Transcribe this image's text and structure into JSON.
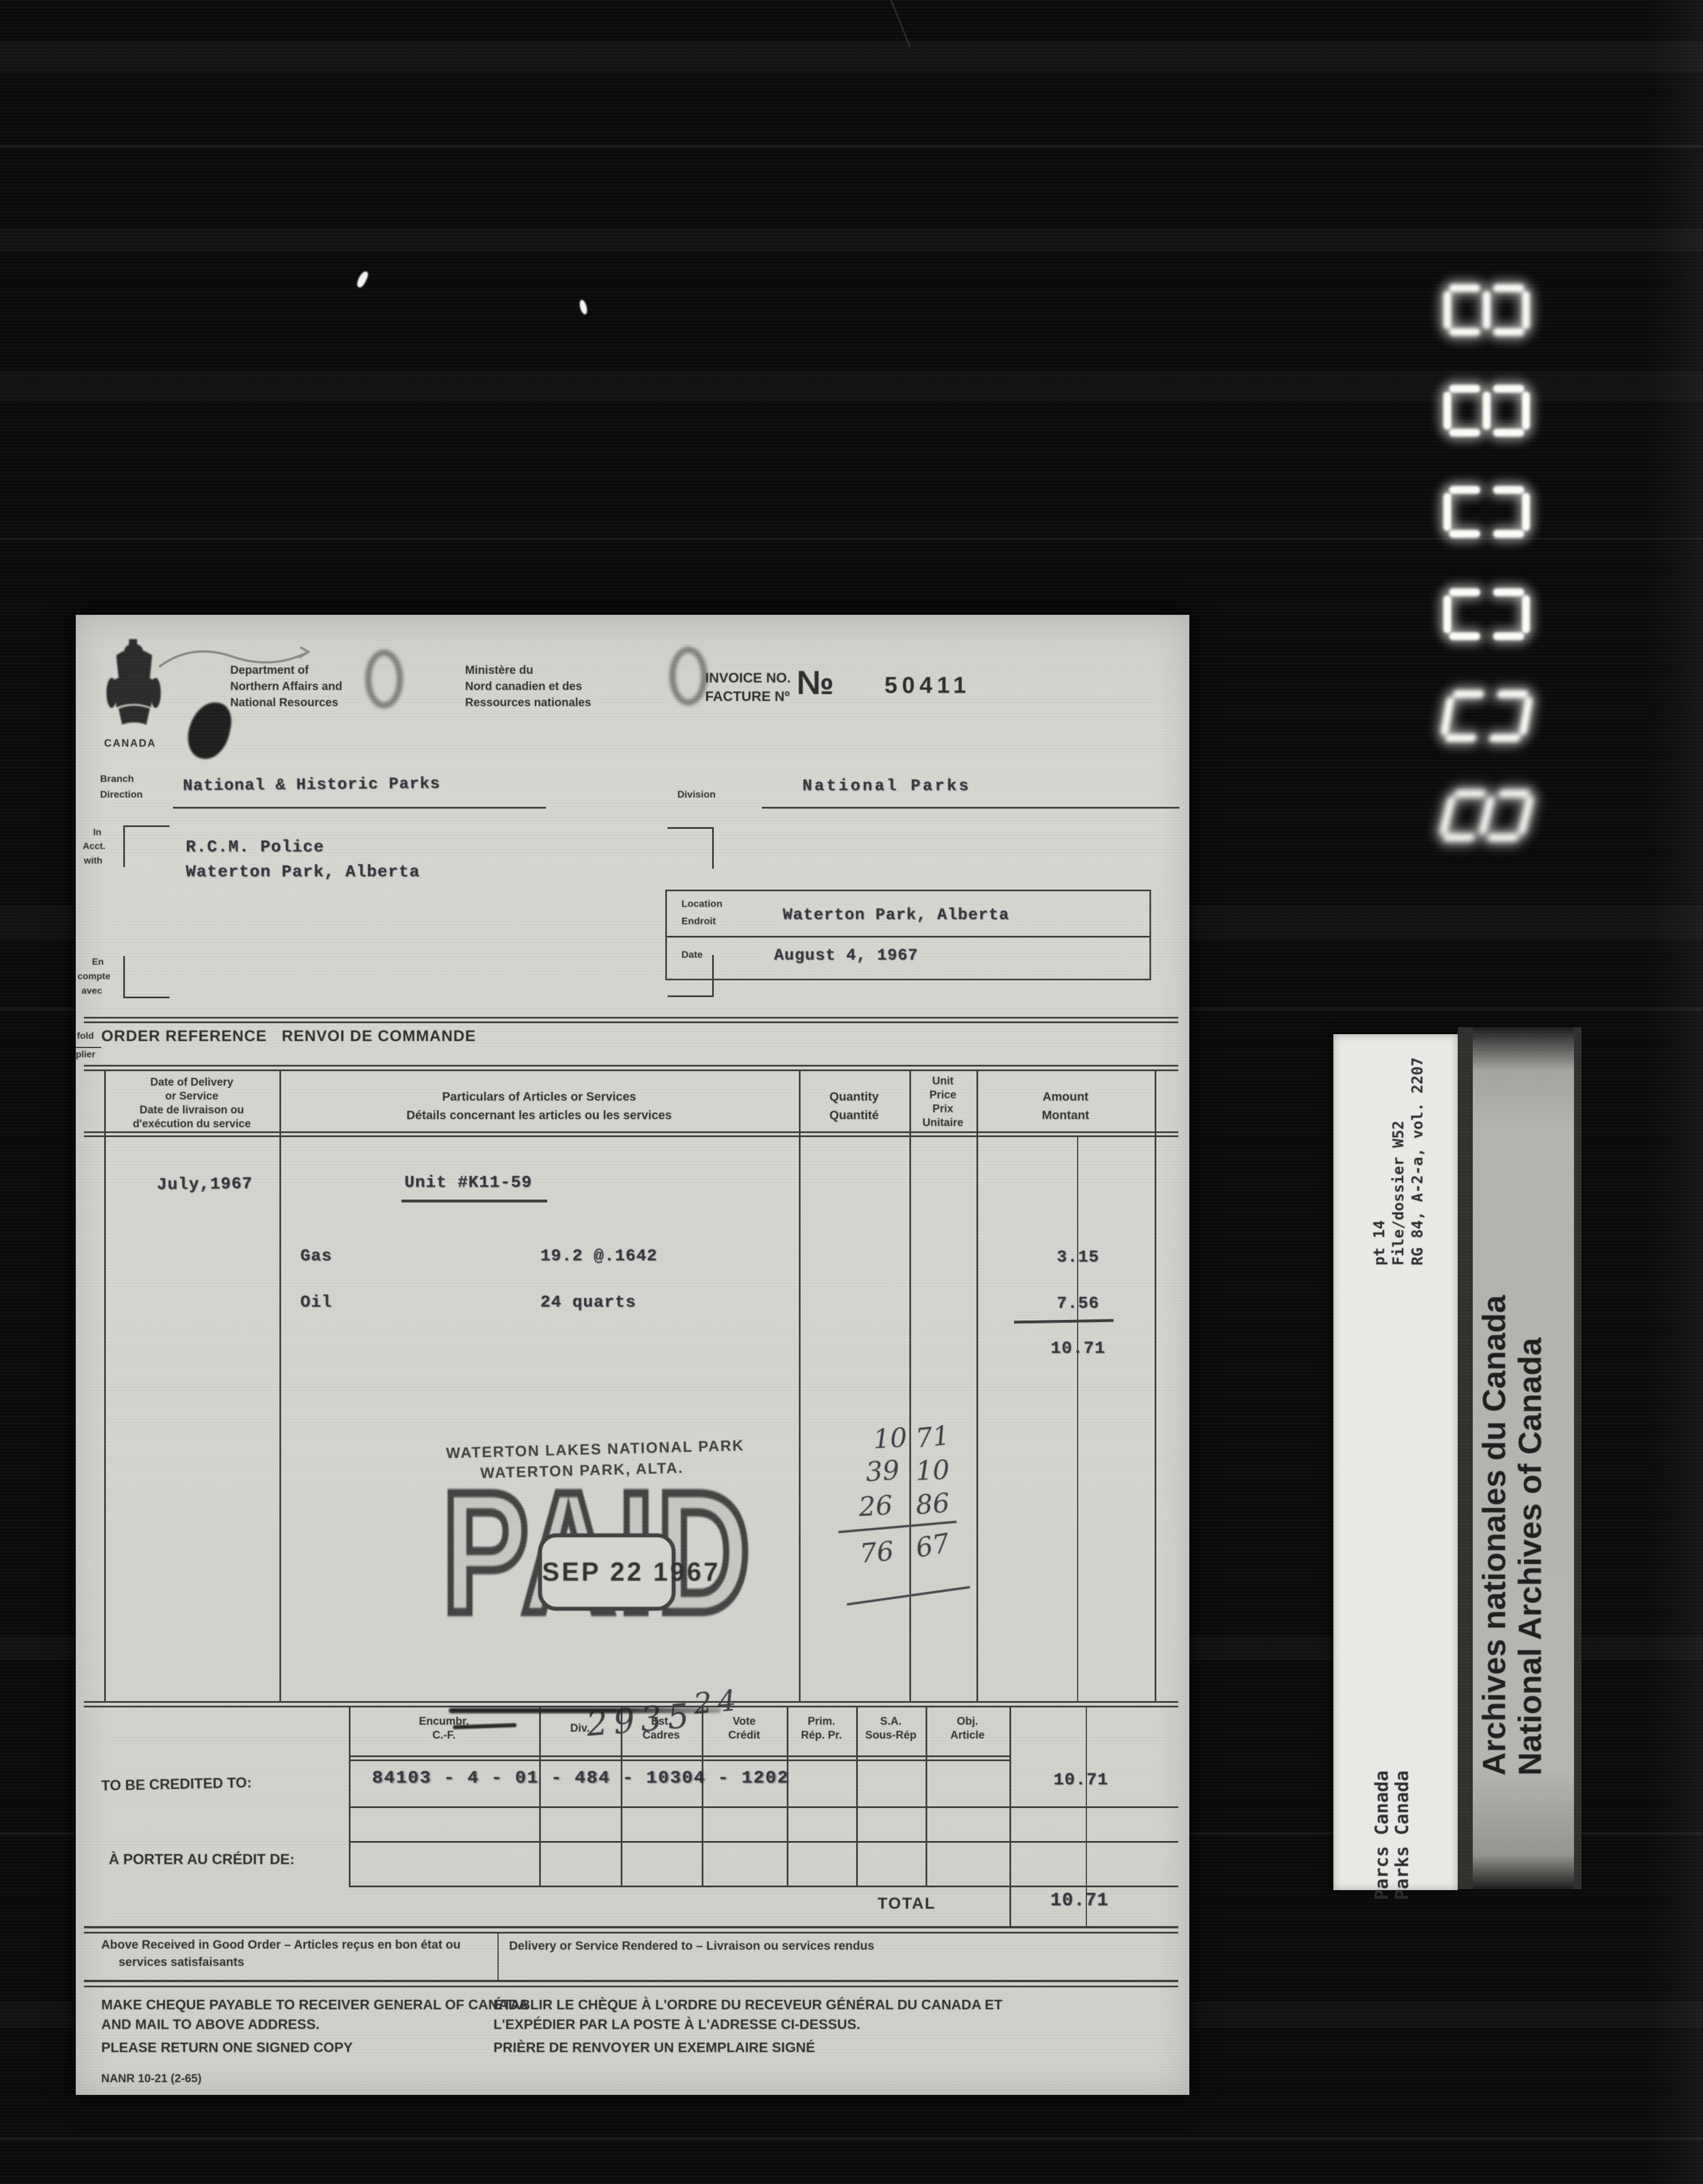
{
  "film": {
    "counter_digits": [
      "8",
      "8",
      "0",
      "0",
      "0",
      "8"
    ],
    "reference_label": {
      "line1": "RG 84, A-2-a, vol. 2207",
      "line2": "File/dossier W52",
      "line3": "pt 14"
    },
    "department_label": {
      "line1": "Parks Canada",
      "line2": "Parcs Canada"
    },
    "archives_banner": {
      "line1": "National Archives of Canada",
      "line2": "Archives nationales du Canada"
    }
  },
  "invoice": {
    "header": {
      "crest_caption": "CANADA",
      "dept_en": [
        "Department of",
        "Northern Affairs and",
        "National Resources"
      ],
      "dept_fr": [
        "Ministère du",
        "Nord canadien et des",
        "Ressources nationales"
      ],
      "invoice_label_en": "INVOICE NO.",
      "invoice_label_fr": "FACTURE Nº",
      "no_symbol": "№",
      "invoice_number": "50411"
    },
    "branch": {
      "label_en": "Branch",
      "label_fr": "Direction",
      "value": "National & Historic Parks"
    },
    "division": {
      "label": "Division",
      "value": "National Parks"
    },
    "account": {
      "label_en": [
        "In",
        "Acct.",
        "with"
      ],
      "label_fr": [
        "En",
        "compte",
        "avec"
      ],
      "name": "R.C.M. Police",
      "address": "Waterton Park, Alberta"
    },
    "location": {
      "label_en": "Location",
      "label_fr": "Endroit",
      "value": "Waterton Park, Alberta"
    },
    "date": {
      "label": "Date",
      "value": "August 4, 1967"
    },
    "fold": {
      "en": "fold",
      "fr": "plier"
    },
    "order_reference": "ORDER REFERENCE   RENVOI DE COMMANDE",
    "table": {
      "col_date": [
        "Date of Delivery",
        "or Service",
        "Date de livraison ou",
        "d'exécution du service"
      ],
      "col_particulars": [
        "Particulars of Articles or Services",
        "Détails concernant les articles ou les services"
      ],
      "col_quantity": [
        "Quantity",
        "Quantité"
      ],
      "col_unit": [
        "Unit",
        "Price",
        "Prix",
        "Unitaire"
      ],
      "col_amount": [
        "Amount",
        "Montant"
      ],
      "service_date": "July,1967",
      "unit_heading": "Unit #K11-59",
      "rows": [
        {
          "item": "Gas",
          "quantity": "19.2 @.1642",
          "amount": "3.15"
        },
        {
          "item": "Oil",
          "quantity": "24 quarts",
          "amount": "7.56"
        }
      ],
      "subtotal": "10.71"
    },
    "stamp": {
      "park_line1": "WATERTON LAKES NATIONAL PARK",
      "park_line2": "WATERTON PARK, ALTA.",
      "paid": "PAID",
      "date": "SEP 22 1967"
    },
    "handwriting": {
      "receipt_number": "293524",
      "tally": [
        [
          "10",
          "71"
        ],
        [
          "39",
          "10"
        ],
        [
          "26",
          "86"
        ],
        [
          "76",
          "67"
        ]
      ]
    },
    "credit": {
      "headers": [
        [
          "Encumbr.",
          "C.-F."
        ],
        [
          "Div."
        ],
        [
          "Est.",
          "Cadres"
        ],
        [
          "Vote",
          "Crédit"
        ],
        [
          "Prim.",
          "Rép. Pr."
        ],
        [
          "S.A.",
          "Sous-Rép"
        ],
        [
          "Obj.",
          "Article"
        ]
      ],
      "credited_label": "TO BE CREDITED TO:",
      "code": "84103 - 4 - 01 - 484 - 10304 - 1202",
      "amount": "10.71",
      "porter_label": "À PORTER AU CRÉDIT DE:",
      "total_label": "TOTAL",
      "total": "10.71"
    },
    "footer": {
      "received": "Above Received in Good Order – Articles reçus en bon état ou",
      "received2": "services satisfaisants",
      "delivery": "Delivery or Service Rendered to – Livraison ou services rendus",
      "payable_en": [
        "MAKE CHEQUE PAYABLE TO RECEIVER GENERAL OF CANADA",
        "AND MAIL TO ABOVE ADDRESS.",
        "PLEASE RETURN ONE SIGNED COPY"
      ],
      "payable_fr": [
        "ÉTABLIR LE CHÈQUE À L'ORDRE DU RECEVEUR GÉNÉRAL DU CANADA ET",
        "L'EXPÉDIER PAR LA POSTE À L'ADRESSE CI-DESSUS.",
        "PRIÈRE DE RENVOYER UN EXEMPLAIRE SIGNÉ"
      ],
      "form_number": "NANR 10-21 (2-65)"
    }
  }
}
